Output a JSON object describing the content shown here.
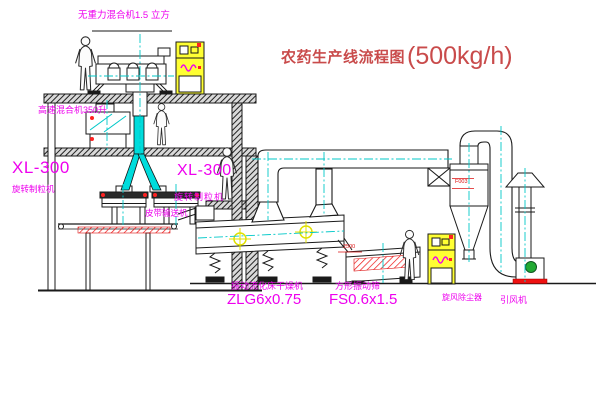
{
  "title": {
    "text": "农药生产线流程图",
    "capacity": "(500kg/h)"
  },
  "equipment_labels": {
    "gravity_mixer": "无重力混合机1.5 立方",
    "high_speed_mixer": "高速混合机350升",
    "granulator_left": {
      "model": "XL-300",
      "name": "旋转制粒机"
    },
    "granulator_right": {
      "model": "XL-300",
      "name": "旋转制粒机"
    },
    "belt_conveyor": "皮带输送机",
    "dryer": {
      "name": "振动流化床干燥机",
      "model": "ZLG6x0.75"
    },
    "sieve": {
      "name": "方形振动筛",
      "model": "FS0.6x1.5"
    },
    "cyclone": "旋风除尘器",
    "fan": "引风机"
  },
  "annotations": {
    "cyclone_tag": "F003",
    "sieve_dim": "2500"
  },
  "colors": {
    "label_magenta": "#ee00ee",
    "title_red": "#c94b4b",
    "annotation_red": "#dd1111",
    "centerline_cyan": "#00c8c8",
    "cabinet_yellow": "#ffff33",
    "motor_green": "#22aa33",
    "alert_red": "#ff2222",
    "line_black": "#1a1a1a"
  }
}
